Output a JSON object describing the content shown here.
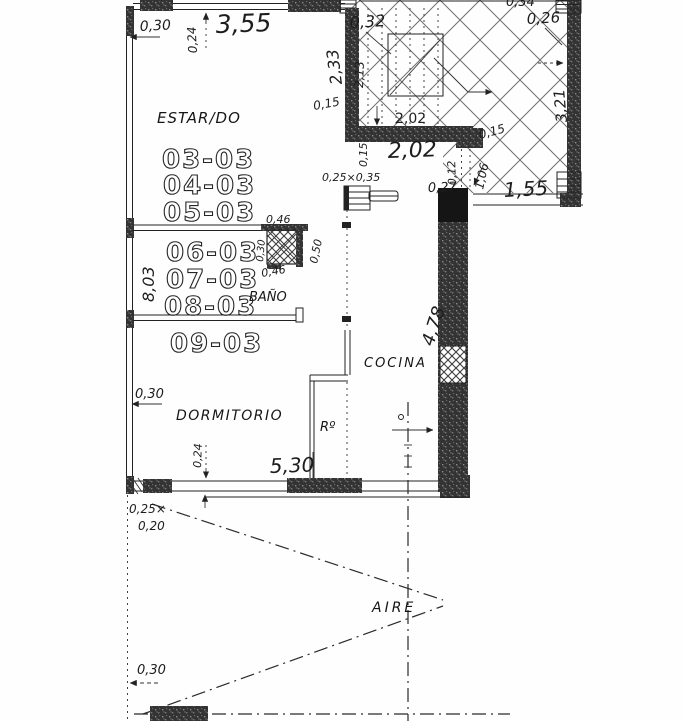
{
  "plan": {
    "title": "scanned apartment floor plan",
    "rooms": {
      "living": "ESTAR/DO",
      "bath": "BAÑO",
      "bedroom": "DORMITORIO",
      "kitchen": "COCINA",
      "closet": "Rº",
      "air_shaft": "AIRE"
    },
    "unit_numbers": [
      "03-03",
      "04-03",
      "05-03",
      "06-03",
      "07-03",
      "08-03",
      "09-03"
    ],
    "dimensions": {
      "d_030_top": "0,30",
      "d_024_top": "0,24",
      "d_355": "3,55",
      "d_233": "2,33",
      "d_015_left": "0,15",
      "d_032": "0,32",
      "d_213": "2,13",
      "d_026": "0,26",
      "d_034_partial": "0,34",
      "d_321": "3,21",
      "d_202_stair": "2,02",
      "d_202_hand": "2,02",
      "d_015_stairwall": "0,15",
      "d_015_well": "0,15",
      "d_012": "0,12",
      "d_106": "1,06",
      "d_027": "0,27",
      "d_155": "1,55",
      "duct_bath": "0,25×0,35",
      "d_046_top": "0,46",
      "d_030_duct": "0,30",
      "d_050_duct": "0,50",
      "d_046_bottom": "0,46",
      "d_803": "8,03",
      "d_030_dorm": "0,30",
      "d_024_bottom": "0,24",
      "d_530": "5,30",
      "d_478": "4,78",
      "duct_air_a": "0,25×",
      "duct_air_b": "0,20",
      "d_030_bottom": "0,30"
    },
    "colors": {
      "ink": "#1d1d1d",
      "wall": "#2e2e2e",
      "paper": "#fefefe"
    }
  }
}
